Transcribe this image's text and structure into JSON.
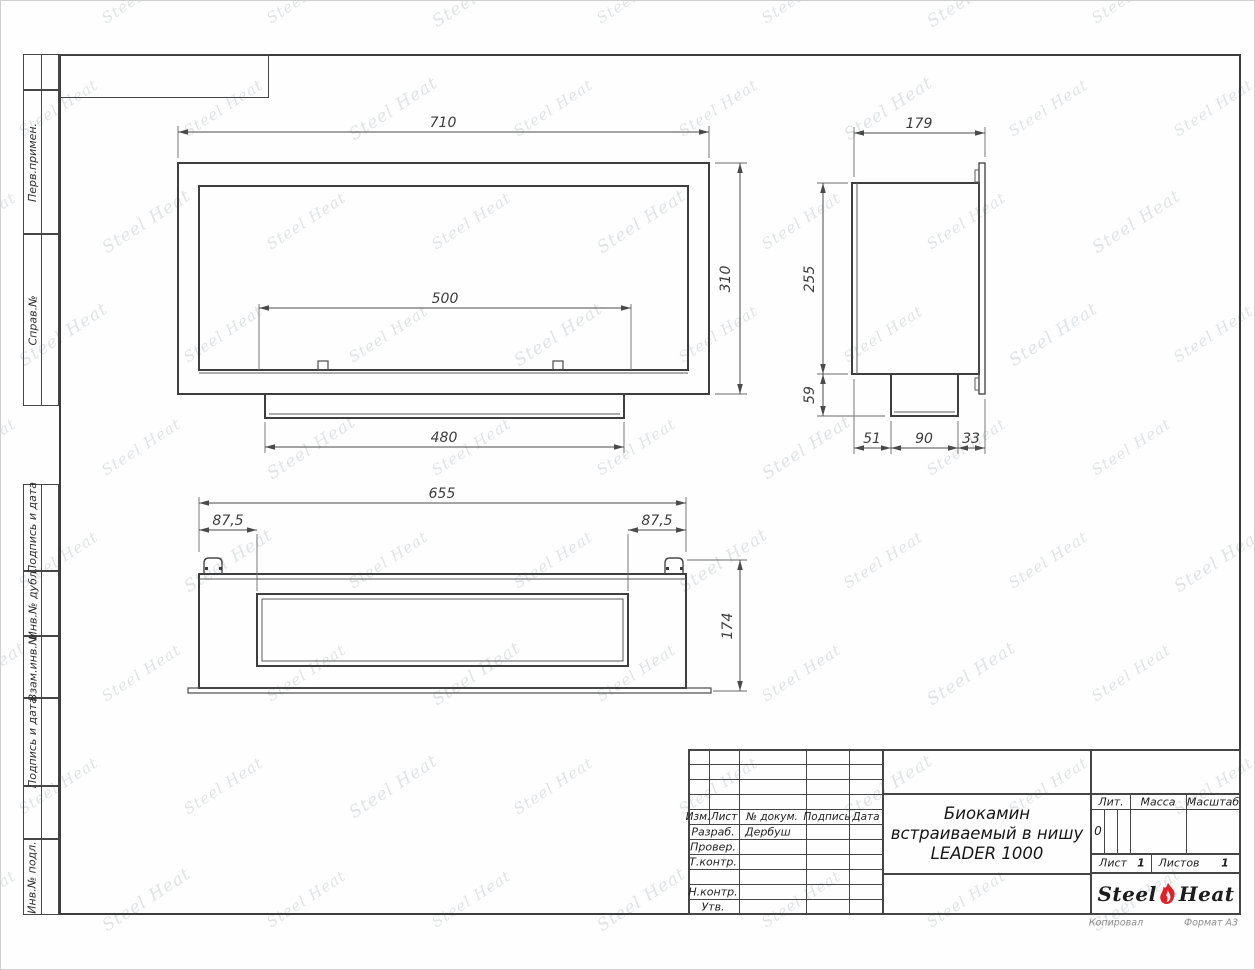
{
  "sheet": {
    "watermark_text": "Steel Heat",
    "side_labels": [
      "Перв.примен.",
      "Справ.№",
      "Подпись и дата",
      "Инв.№ дубл.",
      "Взам.инв.№",
      "Подпись и дата",
      "Инв.№ подл."
    ],
    "footer": {
      "copied": "Копировал",
      "format": "Формат А3"
    }
  },
  "views": {
    "front": {
      "width": "710",
      "height": "310",
      "opening": "500",
      "tray": "480"
    },
    "side": {
      "depth": "179",
      "height": "255",
      "tray_height": "59",
      "seg1": "51",
      "seg2": "90",
      "seg3": "33"
    },
    "bottom": {
      "width": "655",
      "offset_left": "87,5",
      "offset_right": "87,5",
      "height": "174"
    }
  },
  "title_block": {
    "columns": {
      "izm": "Изм.",
      "list": "Лист",
      "doc": "№ докум.",
      "sign": "Подпись",
      "date": "Дата"
    },
    "roles": [
      {
        "label": "Разраб.",
        "value": "Дербуш"
      },
      {
        "label": "Провер.",
        "value": ""
      },
      {
        "label": "Т.контр.",
        "value": ""
      },
      {
        "label": "Н.контр.",
        "value": ""
      },
      {
        "label": "Утв.",
        "value": ""
      }
    ],
    "title_lines": [
      "Биокамин",
      "встраиваемый в нишу",
      "LEADER 1000"
    ],
    "lit_label": "Лит.",
    "lit_value": "0",
    "mass_label": "Масса",
    "scale_label": "Масштаб",
    "sheet_label": "Лист",
    "sheet_number": "1",
    "sheets_label": "Листов",
    "sheets_total": "1",
    "logo": {
      "steel": "Steel",
      "heat": "Heat"
    }
  }
}
